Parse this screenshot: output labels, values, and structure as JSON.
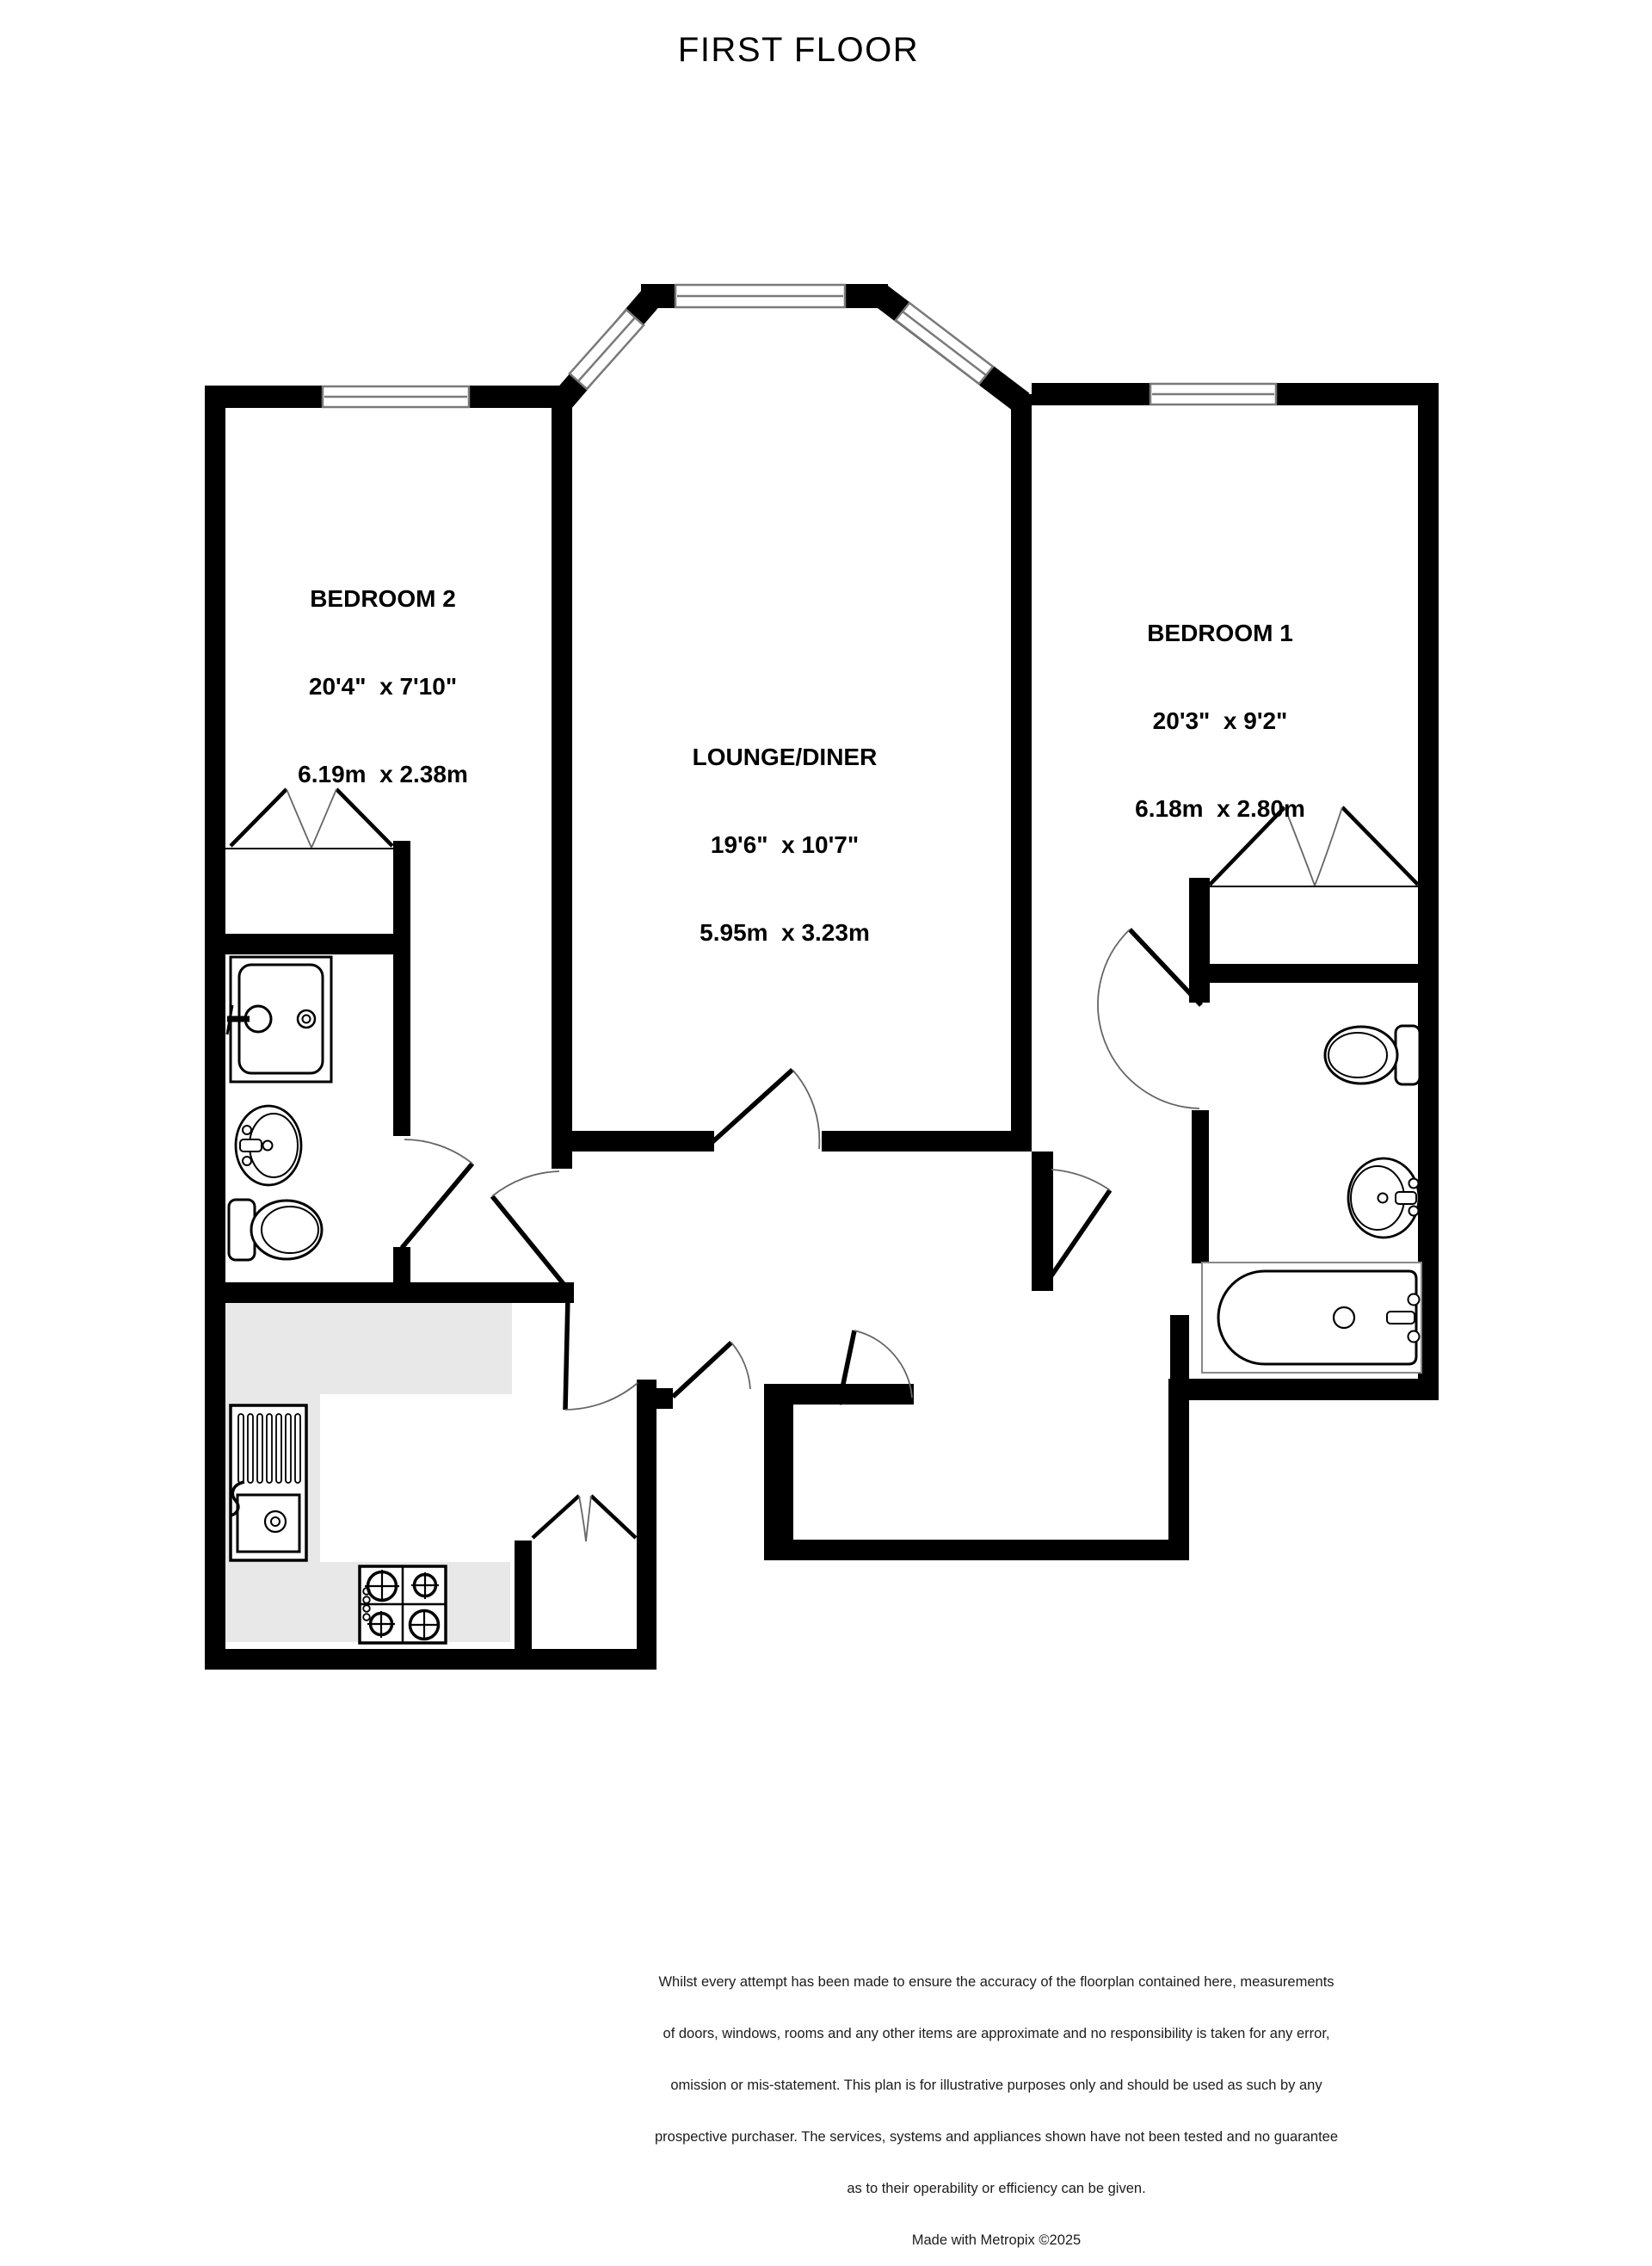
{
  "title": "FIRST FLOOR",
  "rooms": [
    {
      "id": "bedroom-2",
      "name": "BEDROOM 2",
      "imperial": "20'4\"  x 7'10\"",
      "metric": "6.19m  x 2.38m"
    },
    {
      "id": "lounge-diner",
      "name": "LOUNGE/DINER",
      "imperial": "19'6\"  x 10'7\"",
      "metric": "5.95m  x 3.23m"
    },
    {
      "id": "bedroom-1",
      "name": "BEDROOM 1",
      "imperial": "20'3\"  x 9'2\"",
      "metric": "6.18m  x 2.80m"
    }
  ],
  "fixtures": [
    "shower-tray",
    "wash-basin-left",
    "toilet-left",
    "kitchen-sink",
    "hob",
    "kitchen-counter",
    "toilet-right",
    "wash-basin-right",
    "bath",
    "wardrobe-bedroom-2",
    "wardrobe-bedroom-1",
    "storage-cupboard",
    "bay-window",
    "window-bedroom-2",
    "window-bedroom-1"
  ],
  "disclaimer_lines": [
    "Whilst every attempt has been made to ensure the accuracy of the floorplan contained here, measurements",
    "of doors, windows, rooms and any other items are approximate and no responsibility is taken for any error,",
    "omission or mis-statement. This plan is for illustrative purposes only and should be used as such by any",
    "prospective purchaser. The services, systems and appliances shown have not been tested and no guarantee",
    "as to their operability or efficiency can be given."
  ],
  "credit": "Made with Metropix ©2025",
  "colors": {
    "wall": "#000000",
    "glazing": "#7a7a7a",
    "door_arc": "#666666",
    "counter": "#e8e8e8",
    "background": "#ffffff"
  }
}
